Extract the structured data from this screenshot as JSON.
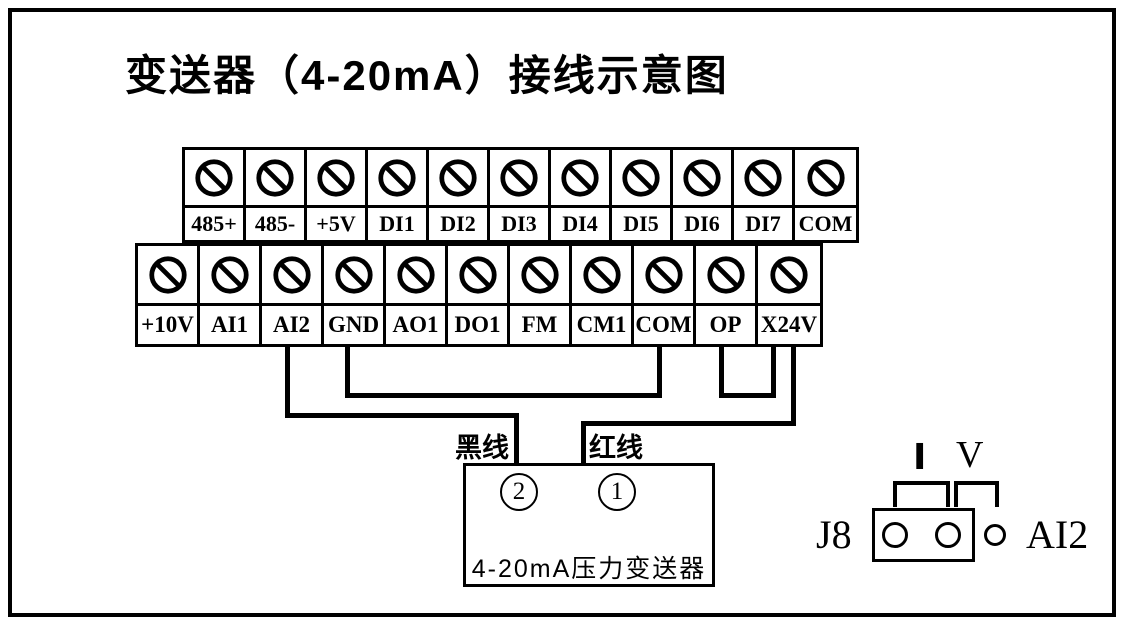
{
  "title": "变送器（4-20mA）接线示意图",
  "terminal_rows": {
    "top": [
      "485+",
      "485-",
      "+5V",
      "DI1",
      "DI2",
      "DI3",
      "DI4",
      "DI5",
      "DI6",
      "DI7",
      "COM"
    ],
    "bottom": [
      "+10V",
      "AI1",
      "AI2",
      "GND",
      "AO1",
      "DO1",
      "FM",
      "CM1",
      "COM",
      "OP",
      "X24V"
    ]
  },
  "wiring": {
    "black_wire_label": "黑线",
    "red_wire_label": "红线",
    "connections": [
      {
        "from": "AI2",
        "to": "transmitter pin 2",
        "wire": "黑线"
      },
      {
        "from": "X24V",
        "to": "transmitter pin 1",
        "wire": "红线"
      },
      {
        "from": "GND",
        "to": "COM",
        "wire": "jumper"
      },
      {
        "from": "OP",
        "to": "X24V",
        "wire": "jumper"
      }
    ]
  },
  "transmitter": {
    "pin_left": "2",
    "pin_right": "1",
    "label": "4-20mA压力变送器"
  },
  "jumper_setting": {
    "connector": "J8",
    "current_label": "I",
    "voltage_label": "V",
    "channel_label": "AI2"
  },
  "colors": {
    "ink": "#000000",
    "background": "#ffffff"
  }
}
